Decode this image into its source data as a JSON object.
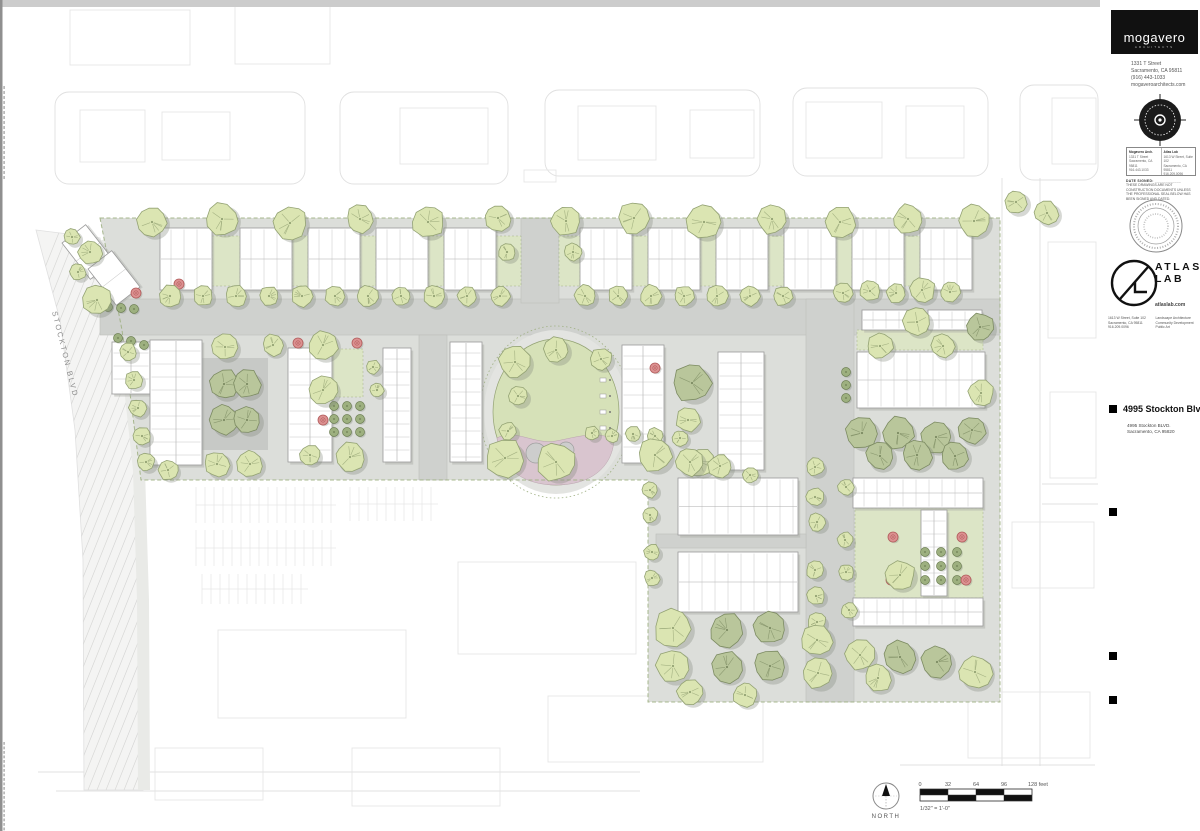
{
  "title_block": {
    "firm": {
      "logo_text": "mogavero",
      "logo_sub": "ARCHITECTS",
      "address_lines": [
        "1331 T Street",
        "Sacramento, CA 95811",
        "(916) 443-1033",
        "mogaveroarchitects.com"
      ]
    },
    "consultant_box": {
      "col1_head": "Mogavero Arch.",
      "col1_lines": [
        "1331 T Street",
        "Sacramento, CA 95811",
        "916.443.1033"
      ],
      "col2_head": "Atlas Lab",
      "col2_lines": [
        "1613 W Street, Suite 102",
        "Sacramento, CA 95811",
        "916.209.0096"
      ]
    },
    "disclaimer": {
      "date_label": "DATE SIGNED: ____________",
      "text": "THESE DRAWINGS ARE NOT CONSTRUCTION DOCUMENTS UNLESS THE PROFESSIONAL SEAL BELOW HAS BEEN SIGNED AND DATED."
    },
    "atlas": {
      "name_line1": "ATLAS",
      "name_line2": "LAB",
      "site": "atlaslab.com",
      "address_lines": [
        "1613 W Street, Suite 102",
        "Sacramento, CA 95811",
        "916.209.0096"
      ],
      "services": [
        "Landscape Architecture",
        "Community Development",
        "Public Art"
      ]
    },
    "project": {
      "title": "4995 Stockton Blvd",
      "address_lines": [
        "4995 Stockton BLVD.",
        "Sacramento, CA 95820"
      ]
    }
  },
  "plan_labels": {
    "street": "STOCKTON BLVD",
    "north": "NORTH",
    "scale_ticks": [
      "0",
      "32",
      "64",
      "96",
      "128 feet"
    ],
    "scale_note": "1/32\" = 1'-0\""
  },
  "colors": {
    "top_band": "#cccccc",
    "edge_strip": "#8f8f8f",
    "ctx": "#e0e0e0",
    "ctx_bld": "#e6e6e6",
    "site_base": "#dcdeda",
    "road": "#cfd1ce",
    "curb": "#bdbfbc",
    "plaza": "#c7c9c6",
    "sidewalk": "#e9eae7",
    "hatch": "#d8d8d7",
    "stockton_fill": "#f4f4f3",
    "green": "#dde6c5",
    "green_light": "#e1e8cc",
    "walk": "#e3e4e1",
    "lawn": "#d6e1b8",
    "pink": "#d9c5cf",
    "boulder": "#cdcdcd",
    "boulder_stroke": "#9e9e9e",
    "building": "#ffffff",
    "building_stroke": "#9a9a9a",
    "unit_line": "#c6c6c6",
    "mid_line": "#adadad",
    "bld_shadow": "#a8aba4",
    "tree_light": "#dbe5b2",
    "tree_light_stroke": "#93a273",
    "tree_sage": "#b9c69b",
    "tree_sage_stroke": "#7c8b62",
    "tree_shadow": "#7e857a",
    "bush": "#9db07f",
    "bush_stroke": "#6d7f53",
    "red": "#dc9191",
    "red_stroke": "#b25c5c",
    "boundary": "#9fb083",
    "label": "#8b8b8b",
    "dark_text": "#555555"
  },
  "plan": {
    "site_path": "M100,218 L1000,218 L1000,702 L648,702 L648,480 L141,480 L122,330 Z",
    "stockton_poly": "M36,230 L100,238 L122,330 L138,470 L142,600 L143,790 L84,790 L83,560 L75,430 L60,320 Z",
    "sidewalk_line": "M102,240 L124,332 L139,470 L143,600 L144,790",
    "roads": [
      [
        100,
        299,
        900,
        36
      ],
      [
        521,
        218,
        38,
        85
      ],
      [
        806,
        299,
        48,
        403
      ],
      [
        419,
        335,
        28,
        145
      ],
      [
        656,
        534,
        150,
        14
      ]
    ],
    "plaza": [
      200,
      358,
      68,
      92
    ],
    "greens": [
      [
        297,
        349,
        66,
        48
      ],
      [
        857,
        330,
        126,
        20
      ],
      [
        855,
        508,
        128,
        90
      ],
      [
        212,
        236,
        28,
        50
      ],
      [
        292,
        236,
        16,
        50
      ],
      [
        360,
        236,
        16,
        50
      ],
      [
        428,
        236,
        16,
        50
      ],
      [
        496,
        236,
        25,
        50
      ],
      [
        559,
        236,
        21,
        50
      ],
      [
        632,
        236,
        16,
        50
      ],
      [
        700,
        236,
        16,
        50
      ],
      [
        768,
        236,
        16,
        50
      ],
      [
        836,
        236,
        16,
        50
      ],
      [
        904,
        236,
        16,
        50
      ]
    ],
    "park": {
      "cx": 556,
      "cy": 412,
      "rx": 63,
      "ry": 73
    },
    "benches": [
      [
        600,
        378
      ],
      [
        600,
        394
      ],
      [
        600,
        410
      ],
      [
        600,
        426
      ]
    ],
    "buildings": [
      [
        160,
        228,
        52,
        62,
        "h"
      ],
      [
        240,
        228,
        52,
        62,
        "h"
      ],
      [
        308,
        228,
        52,
        62,
        "h"
      ],
      [
        376,
        228,
        52,
        62,
        "h"
      ],
      [
        444,
        228,
        52,
        62,
        "h"
      ],
      [
        580,
        228,
        52,
        62,
        "h"
      ],
      [
        648,
        228,
        52,
        62,
        "h"
      ],
      [
        716,
        228,
        52,
        62,
        "h"
      ],
      [
        784,
        228,
        52,
        62,
        "h"
      ],
      [
        852,
        228,
        52,
        62,
        "h"
      ],
      [
        920,
        228,
        52,
        62,
        "h"
      ],
      [
        112,
        342,
        38,
        52,
        "v"
      ],
      [
        150,
        340,
        52,
        125,
        "v"
      ],
      [
        288,
        348,
        44,
        114,
        "v"
      ],
      [
        383,
        348,
        28,
        114,
        "v"
      ],
      [
        450,
        342,
        32,
        120,
        "v"
      ],
      [
        622,
        345,
        42,
        118,
        "v"
      ],
      [
        718,
        352,
        46,
        118,
        "v"
      ],
      [
        862,
        310,
        58,
        20,
        "h"
      ],
      [
        928,
        310,
        54,
        20,
        "h"
      ],
      [
        857,
        352,
        128,
        56,
        "h"
      ],
      [
        678,
        478,
        120,
        57,
        "h"
      ],
      [
        678,
        552,
        120,
        60,
        "h"
      ],
      [
        853,
        478,
        130,
        30,
        "h"
      ],
      [
        853,
        598,
        130,
        28,
        "h"
      ],
      [
        921,
        510,
        26,
        86,
        "v"
      ]
    ],
    "rot_buildings": [
      [
        88,
        252,
        30,
        46,
        -38
      ],
      [
        114,
        278,
        30,
        46,
        -38
      ]
    ],
    "trees": [
      [
        152,
        222,
        15,
        0
      ],
      [
        222,
        219,
        16,
        0
      ],
      [
        290,
        223,
        17,
        0
      ],
      [
        360,
        219,
        14,
        0
      ],
      [
        428,
        222,
        16,
        0
      ],
      [
        498,
        218,
        13,
        0
      ],
      [
        566,
        221,
        15,
        0
      ],
      [
        634,
        218,
        16,
        0
      ],
      [
        704,
        222,
        17,
        0
      ],
      [
        772,
        219,
        15,
        0
      ],
      [
        840,
        222,
        16,
        0
      ],
      [
        908,
        219,
        15,
        0
      ],
      [
        974,
        221,
        16,
        0
      ],
      [
        1016,
        202,
        12,
        0
      ],
      [
        1047,
        213,
        12,
        0
      ],
      [
        170,
        296,
        11,
        0
      ],
      [
        203,
        296,
        10,
        0
      ],
      [
        236,
        296,
        11,
        0
      ],
      [
        269,
        296,
        10,
        0
      ],
      [
        302,
        296,
        11,
        0
      ],
      [
        335,
        296,
        10,
        0
      ],
      [
        368,
        296,
        11,
        0
      ],
      [
        401,
        296,
        10,
        0
      ],
      [
        434,
        296,
        11,
        0
      ],
      [
        467,
        296,
        10,
        0
      ],
      [
        500,
        296,
        10,
        0
      ],
      [
        585,
        296,
        11,
        0
      ],
      [
        618,
        296,
        10,
        0
      ],
      [
        651,
        296,
        11,
        0
      ],
      [
        684,
        296,
        10,
        0
      ],
      [
        717,
        296,
        11,
        0
      ],
      [
        750,
        296,
        10,
        0
      ],
      [
        783,
        296,
        10,
        0
      ],
      [
        843,
        293,
        10,
        0
      ],
      [
        870,
        291,
        10,
        0
      ],
      [
        896,
        293,
        10,
        0
      ],
      [
        922,
        290,
        13,
        0
      ],
      [
        950,
        292,
        10,
        0
      ],
      [
        507,
        252,
        9,
        0
      ],
      [
        573,
        252,
        9,
        0
      ],
      [
        72,
        237,
        8,
        0
      ],
      [
        90,
        252,
        12,
        0
      ],
      [
        78,
        272,
        8,
        0
      ],
      [
        97,
        300,
        15,
        0
      ],
      [
        128,
        352,
        9,
        0
      ],
      [
        134,
        380,
        9,
        0
      ],
      [
        138,
        408,
        9,
        0
      ],
      [
        142,
        436,
        9,
        0
      ],
      [
        146,
        462,
        9,
        0
      ],
      [
        225,
        347,
        13,
        0
      ],
      [
        273,
        345,
        11,
        0
      ],
      [
        323,
        345,
        15,
        0
      ],
      [
        373,
        367,
        7,
        0
      ],
      [
        377,
        390,
        7,
        0
      ],
      [
        224,
        384,
        15,
        1
      ],
      [
        247,
        384,
        14,
        1
      ],
      [
        224,
        420,
        15,
        1
      ],
      [
        247,
        420,
        14,
        1
      ],
      [
        217,
        464,
        13,
        0
      ],
      [
        250,
        464,
        13,
        0
      ],
      [
        323,
        390,
        15,
        0
      ],
      [
        310,
        455,
        10,
        0
      ],
      [
        350,
        457,
        15,
        0
      ],
      [
        168,
        470,
        10,
        0
      ],
      [
        515,
        362,
        16,
        0
      ],
      [
        556,
        350,
        13,
        0
      ],
      [
        601,
        359,
        11,
        0
      ],
      [
        518,
        396,
        10,
        0
      ],
      [
        508,
        431,
        9,
        0
      ],
      [
        505,
        458,
        19,
        0
      ],
      [
        556,
        462,
        19,
        0
      ],
      [
        592,
        433,
        7,
        0
      ],
      [
        612,
        436,
        7,
        0
      ],
      [
        633,
        434,
        8,
        0
      ],
      [
        655,
        436,
        8,
        0
      ],
      [
        680,
        438,
        8,
        0
      ],
      [
        692,
        383,
        19,
        1
      ],
      [
        688,
        420,
        12,
        0
      ],
      [
        700,
        462,
        14,
        0
      ],
      [
        917,
        322,
        14,
        0
      ],
      [
        880,
        346,
        13,
        0
      ],
      [
        943,
        346,
        12,
        0
      ],
      [
        980,
        327,
        14,
        1
      ],
      [
        981,
        393,
        13,
        0
      ],
      [
        862,
        433,
        16,
        1
      ],
      [
        898,
        433,
        16,
        1
      ],
      [
        936,
        437,
        16,
        1
      ],
      [
        972,
        430,
        14,
        1
      ],
      [
        880,
        456,
        14,
        1
      ],
      [
        917,
        455,
        15,
        1
      ],
      [
        955,
        456,
        14,
        1
      ],
      [
        655,
        455,
        17,
        0
      ],
      [
        690,
        462,
        14,
        0
      ],
      [
        720,
        466,
        12,
        0
      ],
      [
        750,
        475,
        8,
        0
      ],
      [
        815,
        467,
        9,
        0
      ],
      [
        815,
        497,
        9,
        0
      ],
      [
        817,
        522,
        9,
        0
      ],
      [
        815,
        570,
        9,
        0
      ],
      [
        816,
        596,
        9,
        0
      ],
      [
        817,
        622,
        9,
        0
      ],
      [
        846,
        487,
        8,
        0
      ],
      [
        845,
        540,
        8,
        0
      ],
      [
        846,
        572,
        8,
        0
      ],
      [
        849,
        610,
        8,
        0
      ],
      [
        650,
        490,
        8,
        0
      ],
      [
        650,
        515,
        8,
        0
      ],
      [
        652,
        552,
        8,
        0
      ],
      [
        652,
        578,
        8,
        0
      ],
      [
        900,
        575,
        15,
        0
      ],
      [
        673,
        628,
        19,
        0
      ],
      [
        727,
        630,
        17,
        1
      ],
      [
        770,
        628,
        16,
        1
      ],
      [
        817,
        640,
        16,
        0
      ],
      [
        673,
        666,
        17,
        0
      ],
      [
        727,
        667,
        16,
        1
      ],
      [
        770,
        666,
        16,
        1
      ],
      [
        818,
        673,
        16,
        0
      ],
      [
        860,
        655,
        15,
        0
      ],
      [
        900,
        657,
        16,
        1
      ],
      [
        937,
        662,
        16,
        1
      ],
      [
        975,
        672,
        17,
        0
      ],
      [
        878,
        678,
        14,
        0
      ],
      [
        690,
        692,
        13,
        0
      ],
      [
        745,
        695,
        12,
        0
      ]
    ],
    "reds": [
      [
        179,
        284
      ],
      [
        136,
        293
      ],
      [
        298,
        343
      ],
      [
        357,
        343
      ],
      [
        655,
        368
      ],
      [
        323,
        420
      ],
      [
        893,
        537
      ],
      [
        962,
        537
      ],
      [
        891,
        580
      ],
      [
        966,
        580
      ]
    ],
    "bushes": [
      [
        108,
        307
      ],
      [
        121,
        308
      ],
      [
        134,
        309
      ],
      [
        118,
        338
      ],
      [
        131,
        341
      ],
      [
        144,
        345
      ],
      [
        334,
        406
      ],
      [
        347,
        406
      ],
      [
        360,
        406
      ],
      [
        334,
        419
      ],
      [
        347,
        419
      ],
      [
        360,
        419
      ],
      [
        334,
        432
      ],
      [
        347,
        432
      ],
      [
        360,
        432
      ],
      [
        846,
        372
      ],
      [
        846,
        385
      ],
      [
        846,
        398
      ],
      [
        925,
        552
      ],
      [
        941,
        552
      ],
      [
        957,
        552
      ],
      [
        925,
        566
      ],
      [
        941,
        566
      ],
      [
        957,
        566
      ],
      [
        925,
        580
      ],
      [
        941,
        580
      ],
      [
        957,
        580
      ]
    ],
    "ctx_streets": [
      [
        55,
        92,
        250,
        92
      ],
      [
        340,
        92,
        168,
        92
      ],
      [
        545,
        90,
        215,
        86
      ],
      [
        793,
        88,
        195,
        88
      ],
      [
        1020,
        85,
        78,
        95
      ]
    ],
    "ctx_lines": [
      [
        1002,
        178,
        1002,
        766
      ],
      [
        1040,
        178,
        1040,
        766
      ],
      [
        1042,
        484,
        1098,
        484
      ],
      [
        1042,
        504,
        1098,
        504
      ],
      [
        38,
        772,
        640,
        772
      ],
      [
        56,
        791,
        640,
        791
      ],
      [
        900,
        765,
        1095,
        765
      ]
    ],
    "ctx_buildings": [
      [
        70,
        10,
        120,
        55
      ],
      [
        235,
        6,
        95,
        58
      ],
      [
        80,
        110,
        65,
        52
      ],
      [
        162,
        112,
        68,
        48
      ],
      [
        400,
        108,
        88,
        56
      ],
      [
        578,
        106,
        78,
        54
      ],
      [
        690,
        110,
        64,
        48
      ],
      [
        806,
        102,
        76,
        56
      ],
      [
        906,
        106,
        58,
        52
      ],
      [
        1052,
        98,
        44,
        66
      ],
      [
        1048,
        242,
        48,
        96
      ],
      [
        1050,
        392,
        46,
        86
      ],
      [
        1012,
        522,
        82,
        66
      ],
      [
        968,
        692,
        122,
        66
      ],
      [
        218,
        630,
        188,
        88
      ],
      [
        458,
        562,
        178,
        92
      ],
      [
        548,
        696,
        215,
        66
      ],
      [
        352,
        748,
        148,
        58
      ],
      [
        155,
        748,
        108,
        52
      ],
      [
        524,
        170,
        32,
        12
      ]
    ],
    "parking": [
      [
        196,
        487,
        140,
        36
      ],
      [
        196,
        530,
        140,
        36
      ],
      [
        350,
        487,
        88,
        34
      ],
      [
        202,
        574,
        106,
        30
      ]
    ],
    "north_arrow": {
      "cx": 886,
      "cy": 796,
      "r": 13
    },
    "scale_bar": {
      "x": 920,
      "y": 789,
      "w": 112,
      "seg": 28
    }
  }
}
